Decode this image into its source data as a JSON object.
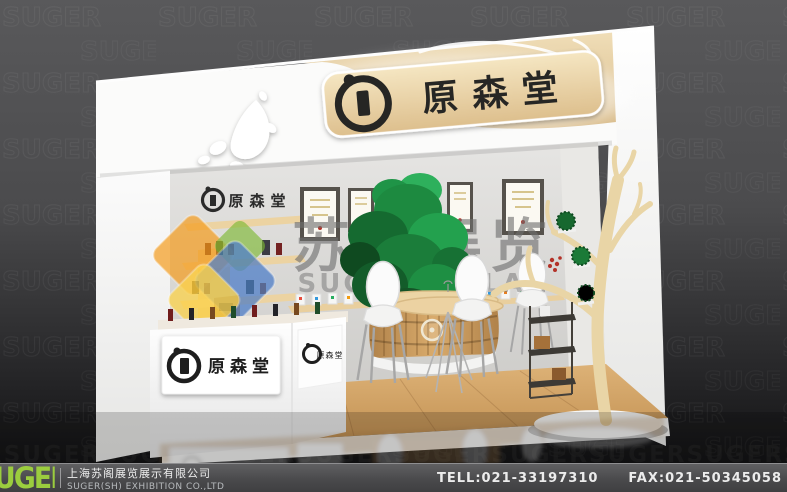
{
  "brand": {
    "name": "原森堂"
  },
  "watermark": {
    "cn": "苏阁展览",
    "en": "SUGEZHANLAN",
    "pattern_word": "SUGER",
    "pattern_row": "RSUGERSUGERSUGERSUGERSUGERSUGERSUGERSUGERSUGERSUGER"
  },
  "footer": {
    "logo_text": "UGER",
    "company_cn": "上海苏阁展览展示有限公司",
    "company_en": "SUGER(SH) EXHIBITION CO.,LTD",
    "tel": "TELL:021-33197310",
    "fax": "FAX:021-50345058"
  },
  "colors": {
    "accent_green": "#9bcd3e",
    "booth_wood": "#e6d2a4",
    "plant_green": "#1d8a40",
    "background_gray": "#4c4c4e",
    "footer_bg": "#4a4a4c",
    "watermark_gray": "#6f6f6f"
  }
}
